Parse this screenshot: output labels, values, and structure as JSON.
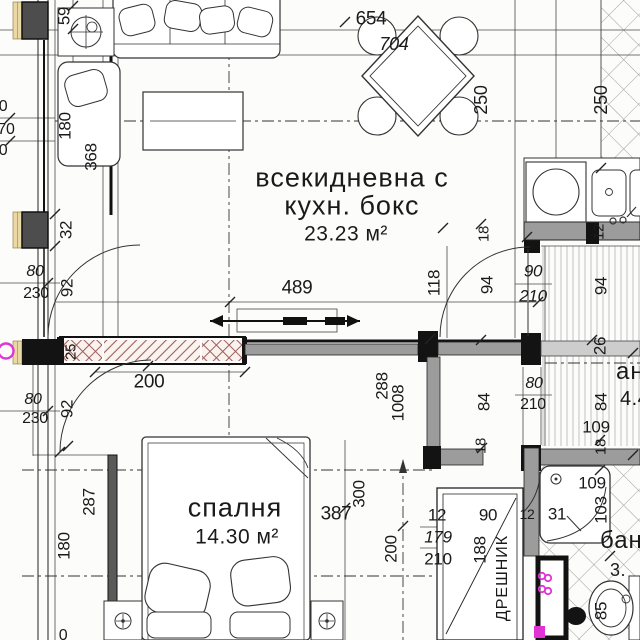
{
  "plan_title": "apartment floor plan",
  "rooms_summary": {
    "living_room": {
      "name": "всекидневна с кухн. бокс",
      "area": "23.23 м²"
    },
    "bedroom": {
      "name": "спалня",
      "area": "14.30 м²"
    },
    "hallway_partial": {
      "name": "ан",
      "area": "4.4"
    },
    "bathroom_partial": {
      "name": "бан",
      "area": "3."
    },
    "closet": {
      "name": "ДРЕШНИК"
    }
  },
  "accent_colors": {
    "electrical_magenta": "#e033d6",
    "wall_gray": "#9c9c9c",
    "hatch_red": "#9c5f5a"
  },
  "labels": [
    {
      "text": "всекидневна с",
      "x": 352,
      "y": 178,
      "size": 27,
      "kind": "room-name"
    },
    {
      "text": "кухн. бокс",
      "x": 352,
      "y": 206,
      "size": 27,
      "kind": "room-name"
    },
    {
      "text": "23.23 м²",
      "x": 346,
      "y": 234,
      "size": 21,
      "kind": "room-area"
    },
    {
      "text": "спалня",
      "x": 235,
      "y": 508,
      "size": 27,
      "kind": "room-name"
    },
    {
      "text": "14.30 м²",
      "x": 237,
      "y": 537,
      "size": 21,
      "kind": "room-area"
    },
    {
      "text": "ан",
      "x": 616,
      "y": 372,
      "size": 24,
      "kind": "room-name",
      "anchor": "left"
    },
    {
      "text": "4.4",
      "x": 620,
      "y": 399,
      "size": 20,
      "kind": "room-area",
      "anchor": "left"
    },
    {
      "text": "бан",
      "x": 600,
      "y": 541,
      "size": 24,
      "kind": "room-name",
      "anchor": "left"
    },
    {
      "text": "3.",
      "x": 610,
      "y": 570,
      "size": 18,
      "kind": "room-area",
      "anchor": "left"
    },
    {
      "text": "ДРЕШНИК",
      "x": 503,
      "y": 578,
      "rot": -90,
      "size": 16,
      "kind": "room-name"
    },
    {
      "text": "59",
      "x": 64,
      "y": 16,
      "rot": -90,
      "kind": "dimension"
    },
    {
      "text": "654",
      "x": 371,
      "y": 19,
      "size": 19,
      "kind": "dimension"
    },
    {
      "text": "704",
      "x": 394,
      "y": 44,
      "size": 18,
      "italic": true,
      "kind": "dimension"
    },
    {
      "text": "250",
      "x": 481,
      "y": 100,
      "rot": -90,
      "size": 18,
      "kind": "dimension"
    },
    {
      "text": "250",
      "x": 601,
      "y": 100,
      "rot": -90,
      "size": 18,
      "kind": "dimension"
    },
    {
      "text": "0",
      "x": 3,
      "y": 107,
      "size": 16,
      "kind": "dimension"
    },
    {
      "text": "70",
      "x": 6,
      "y": 130,
      "size": 16,
      "kind": "dimension"
    },
    {
      "text": "0",
      "x": 3,
      "y": 151,
      "size": 16,
      "kind": "dimension"
    },
    {
      "text": "180",
      "x": 65,
      "y": 126,
      "rot": -90,
      "kind": "dimension"
    },
    {
      "text": "368",
      "x": 91,
      "y": 157,
      "rot": -90,
      "kind": "dimension"
    },
    {
      "text": "32",
      "x": 66,
      "y": 230,
      "rot": -90,
      "kind": "dimension"
    },
    {
      "text": "80",
      "x": 35,
      "y": 272,
      "italic": true,
      "size": 16,
      "kind": "dimension"
    },
    {
      "text": "230",
      "x": 36,
      "y": 294,
      "size": 16,
      "kind": "dimension"
    },
    {
      "text": "92",
      "x": 67,
      "y": 288,
      "rot": -90,
      "kind": "dimension"
    },
    {
      "text": "489",
      "x": 297,
      "y": 288,
      "size": 19,
      "kind": "dimension"
    },
    {
      "text": "118",
      "x": 434,
      "y": 283,
      "rot": -90,
      "kind": "dimension"
    },
    {
      "text": "18",
      "x": 484,
      "y": 234,
      "rot": -90,
      "size": 15,
      "kind": "dimension"
    },
    {
      "text": "94",
      "x": 487,
      "y": 285,
      "rot": -90,
      "kind": "dimension"
    },
    {
      "text": "90",
      "x": 533,
      "y": 271,
      "italic": true,
      "kind": "door-size"
    },
    {
      "text": "210",
      "x": 533,
      "y": 296,
      "italic": true,
      "kind": "door-size"
    },
    {
      "text": "94",
      "x": 601,
      "y": 286,
      "rot": -90,
      "kind": "dimension"
    },
    {
      "text": "12",
      "x": 599,
      "y": 232,
      "rot": -90,
      "size": 15,
      "kind": "dimension"
    },
    {
      "text": "25",
      "x": 71,
      "y": 352,
      "rot": -90,
      "size": 15,
      "kind": "dimension"
    },
    {
      "text": "200",
      "x": 149,
      "y": 382,
      "size": 19,
      "kind": "dimension"
    },
    {
      "text": "80",
      "x": 33,
      "y": 400,
      "italic": true,
      "size": 16,
      "kind": "dimension"
    },
    {
      "text": "230",
      "x": 35,
      "y": 419,
      "size": 16,
      "kind": "dimension"
    },
    {
      "text": "92",
      "x": 67,
      "y": 409,
      "rot": -90,
      "kind": "dimension"
    },
    {
      "text": "288",
      "x": 382,
      "y": 386,
      "rot": -90,
      "kind": "dimension"
    },
    {
      "text": "1008",
      "x": 398,
      "y": 403,
      "rot": -90,
      "kind": "dimension"
    },
    {
      "text": "84",
      "x": 484,
      "y": 402,
      "rot": -90,
      "kind": "dimension"
    },
    {
      "text": "80",
      "x": 534,
      "y": 384,
      "italic": true,
      "size": 16,
      "kind": "door-size"
    },
    {
      "text": "210",
      "x": 533,
      "y": 405,
      "size": 16,
      "kind": "door-size"
    },
    {
      "text": "109",
      "x": 596,
      "y": 427,
      "kind": "dimension"
    },
    {
      "text": "84",
      "x": 601,
      "y": 402,
      "rot": -90,
      "kind": "dimension"
    },
    {
      "text": "26",
      "x": 600,
      "y": 346,
      "rot": -90,
      "kind": "dimension"
    },
    {
      "text": "18",
      "x": 481,
      "y": 446,
      "rot": -90,
      "size": 15,
      "kind": "dimension"
    },
    {
      "text": "18",
      "x": 601,
      "y": 447,
      "rot": -90,
      "size": 15,
      "kind": "dimension"
    },
    {
      "text": "287",
      "x": 89,
      "y": 502,
      "rot": -90,
      "kind": "dimension"
    },
    {
      "text": "300",
      "x": 359,
      "y": 494,
      "rot": -90,
      "kind": "dimension"
    },
    {
      "text": "387",
      "x": 336,
      "y": 514,
      "size": 19,
      "kind": "dimension"
    },
    {
      "text": "200",
      "x": 391,
      "y": 549,
      "rot": -90,
      "kind": "dimension"
    },
    {
      "text": "12",
      "x": 437,
      "y": 515,
      "kind": "dimension"
    },
    {
      "text": "179",
      "x": 438,
      "y": 537,
      "italic": true,
      "kind": "door-size"
    },
    {
      "text": "210",
      "x": 438,
      "y": 559,
      "kind": "door-size"
    },
    {
      "text": "90",
      "x": 488,
      "y": 515,
      "kind": "dimension"
    },
    {
      "text": "188",
      "x": 480,
      "y": 550,
      "rot": -90,
      "kind": "dimension"
    },
    {
      "text": "180",
      "x": 64,
      "y": 546,
      "rot": -90,
      "kind": "dimension"
    },
    {
      "text": "31",
      "x": 557,
      "y": 514,
      "kind": "dimension"
    },
    {
      "text": "109",
      "x": 592,
      "y": 483,
      "kind": "dimension"
    },
    {
      "text": "103",
      "x": 601,
      "y": 510,
      "rot": -90,
      "kind": "dimension"
    },
    {
      "text": "85",
      "x": 601,
      "y": 611,
      "rot": -90,
      "kind": "dimension"
    },
    {
      "text": "0",
      "x": 63,
      "y": 636,
      "size": 16,
      "kind": "dimension"
    },
    {
      "text": "12",
      "x": 527,
      "y": 514,
      "size": 14,
      "kind": "dimension"
    }
  ]
}
